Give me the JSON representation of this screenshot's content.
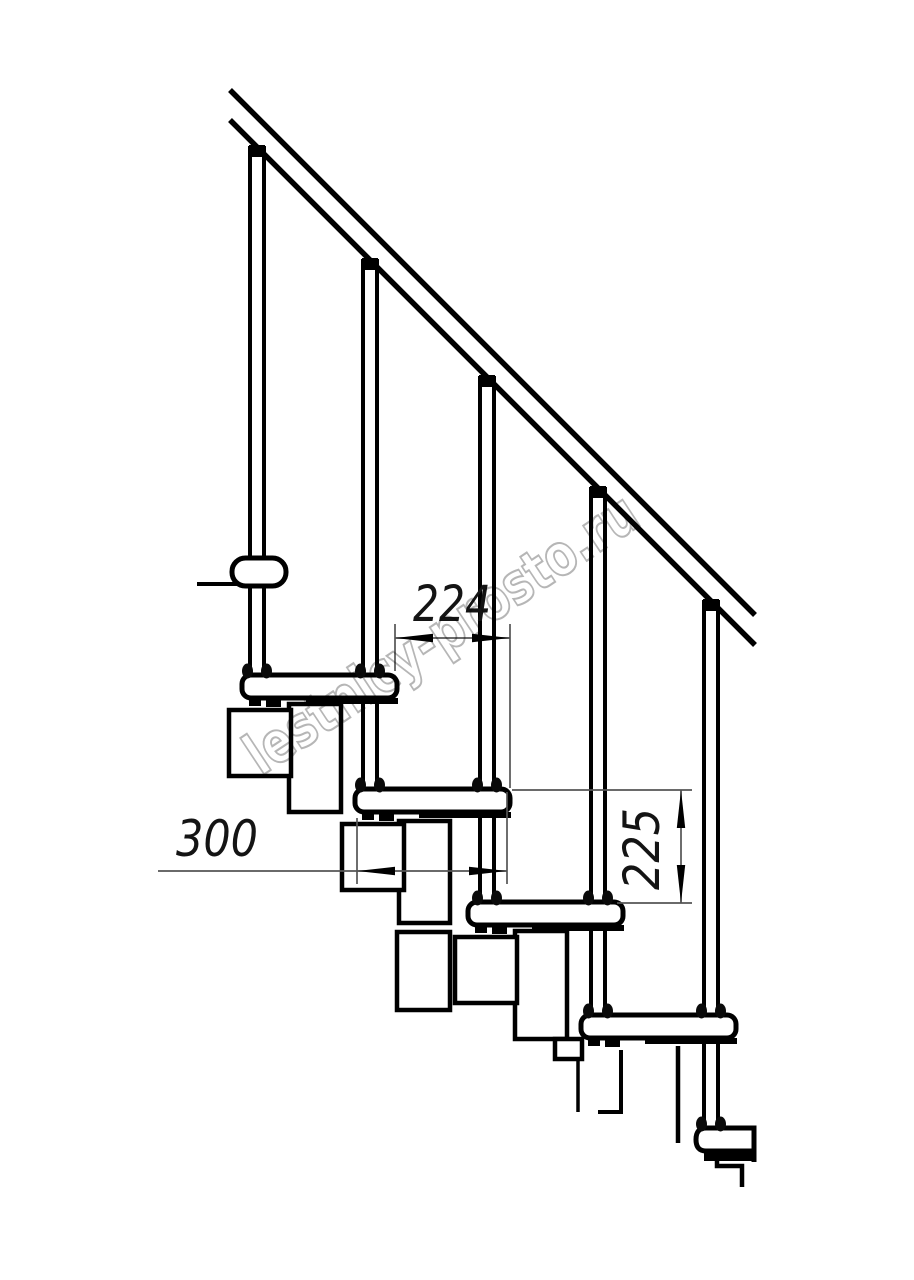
{
  "page": {
    "background_color": "#ffffff"
  },
  "drawing": {
    "description": "Side-view technical drawing of a modular staircase: inclined handrail, five balusters, five treads with interlocking support modules, dimension callouts",
    "line_color": "#000000",
    "thin_line_color": "#555555",
    "dimensions": {
      "step_run": {
        "value": "224",
        "orientation": "horizontal"
      },
      "tread_depth": {
        "value": "300",
        "orientation": "horizontal"
      },
      "step_rise": {
        "value": "225",
        "orientation": "vertical"
      }
    },
    "watermark": {
      "text": "lestnicy-prosto.ru",
      "color": "#b6b6b6"
    }
  }
}
